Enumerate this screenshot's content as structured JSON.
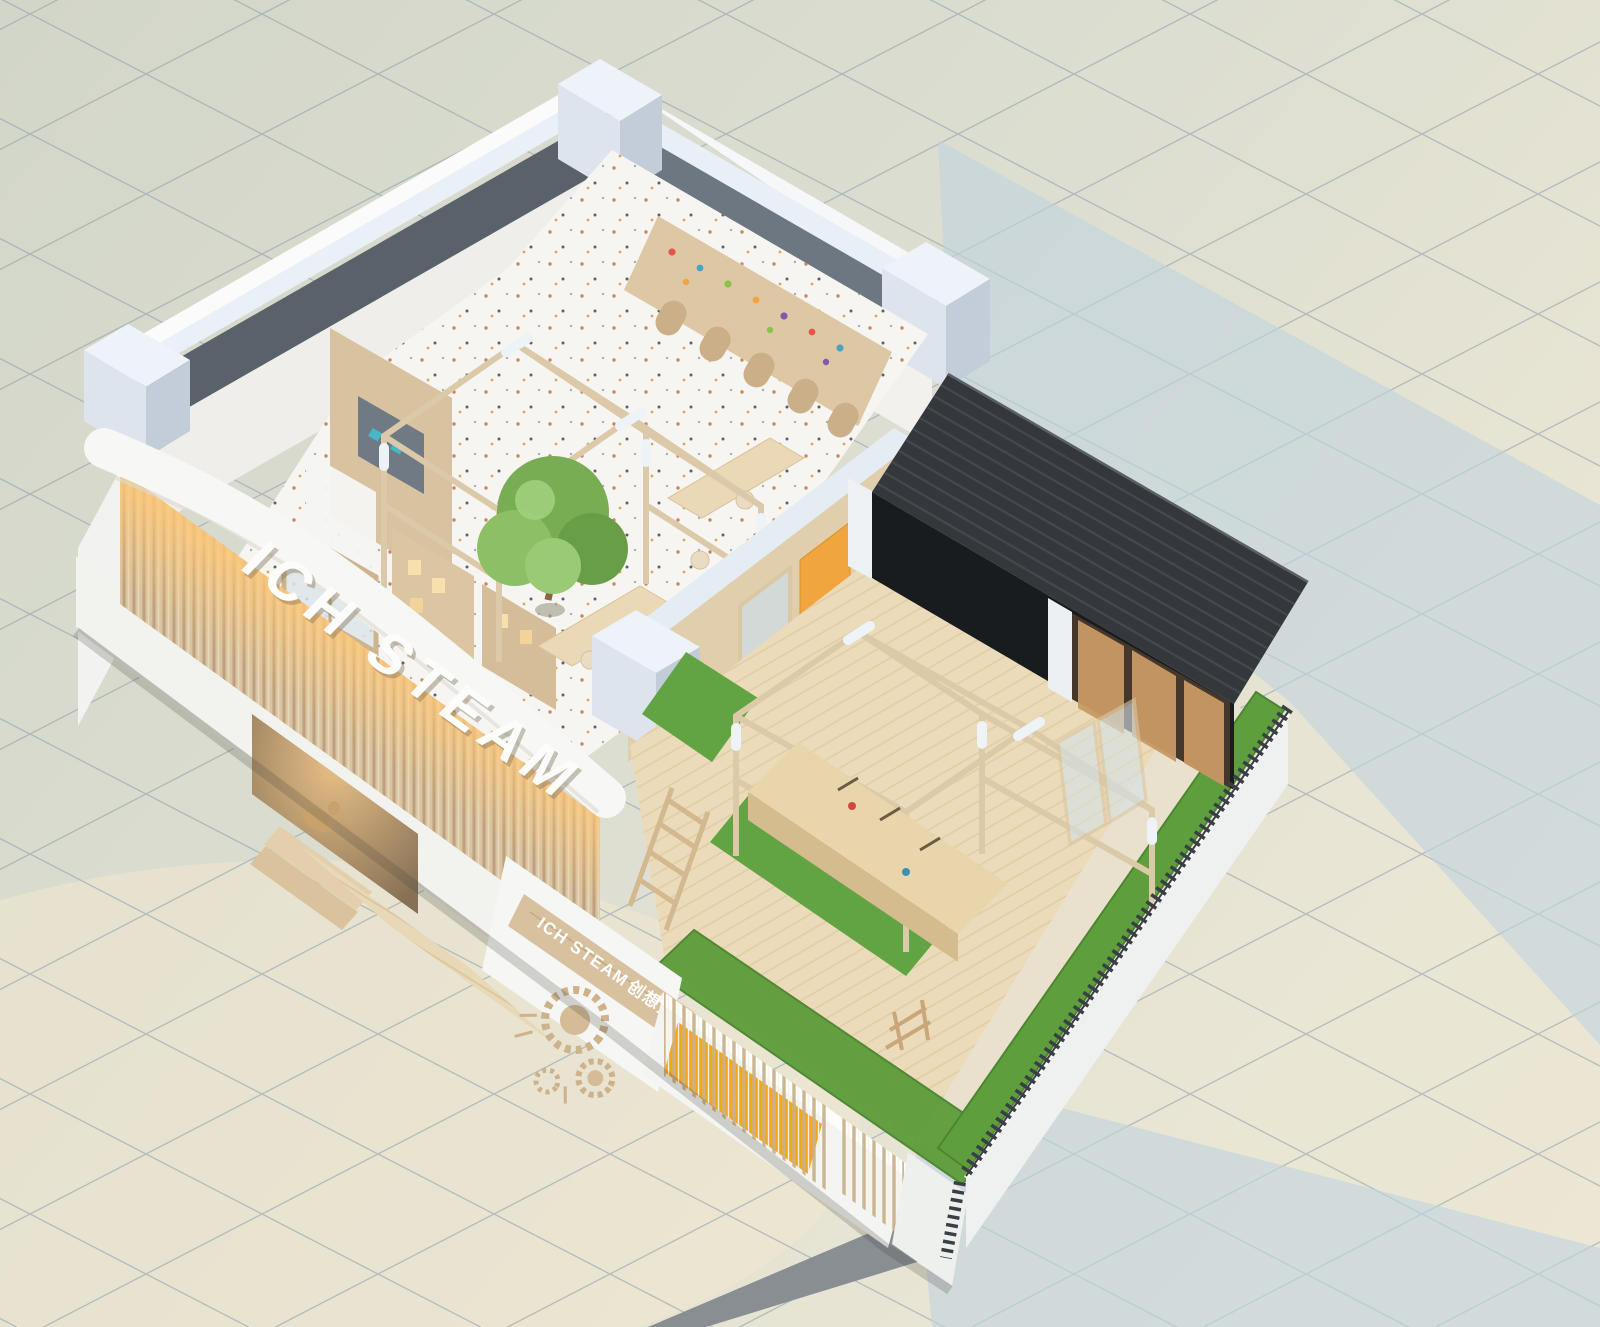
{
  "meta": {
    "title": "Bird's-eye axonometric cutaway render of a kids STEAM workshop interior",
    "view": "isometric cutaway, roof removed",
    "render_style": "3D architectural visualization on tiled ground plane"
  },
  "branding": {
    "facade_letters": "ICH STEAM",
    "signage_latin": "ICH STEAM",
    "signage_cjk": "创想力工坊"
  },
  "palette": {
    "tile_base": "#dadccf",
    "tile_warm": "#f1e8cf",
    "grid_line": "#95a1ae",
    "shadow_blue": "#c2d4de",
    "wall_white": "#f4f5f2",
    "wall_cap_blue": "#e8eff7",
    "wall_cut_grey": "#646d78",
    "wood_light": "#ddc7a5",
    "wood_mid": "#c9ab84",
    "wood_deck": "#ecdbba",
    "terrazzo_floor": "#f7f5f1",
    "turf_green": "#5f9e3d",
    "accent_yellow": "#f3a61a",
    "accent_orange_door": "#f0a53e",
    "annex_roof_dark": "#34383d",
    "annex_front_black": "#191c1f",
    "warm_glow": "#ffc878",
    "tree_green": "#79ad53",
    "fence_dark": "#3a3f45",
    "walkway_grey": "#898e93"
  },
  "zones": [
    {
      "id": "main-studio",
      "label": "main studio room with timber gable frame and tree"
    },
    {
      "id": "display-wing",
      "label": "front display wing with shelf towers"
    },
    {
      "id": "classroom-shelves",
      "label": "toy shelf wall with arched cabinets"
    },
    {
      "id": "outdoor-workshop",
      "label": "outdoor timber workshop yard with pergola and workbench"
    },
    {
      "id": "dark-annex",
      "label": "charcoal timber annex volume"
    },
    {
      "id": "entry-porch",
      "label": "recessed lit entry porch with rocking horse"
    },
    {
      "id": "yellow-niche",
      "label": "yellow slatted bench niche on street wall"
    },
    {
      "id": "fence-garden",
      "label": "turf strips and picket fence boundary"
    }
  ],
  "objects": [
    "tree",
    "rabbit-sculptures",
    "workbench-with-tools",
    "ladder",
    "timber-gable-frames",
    "picket-fence",
    "rocking-horse",
    "gear-relief-logo",
    "folding-glass-doors",
    "wood-deck-ramp"
  ]
}
